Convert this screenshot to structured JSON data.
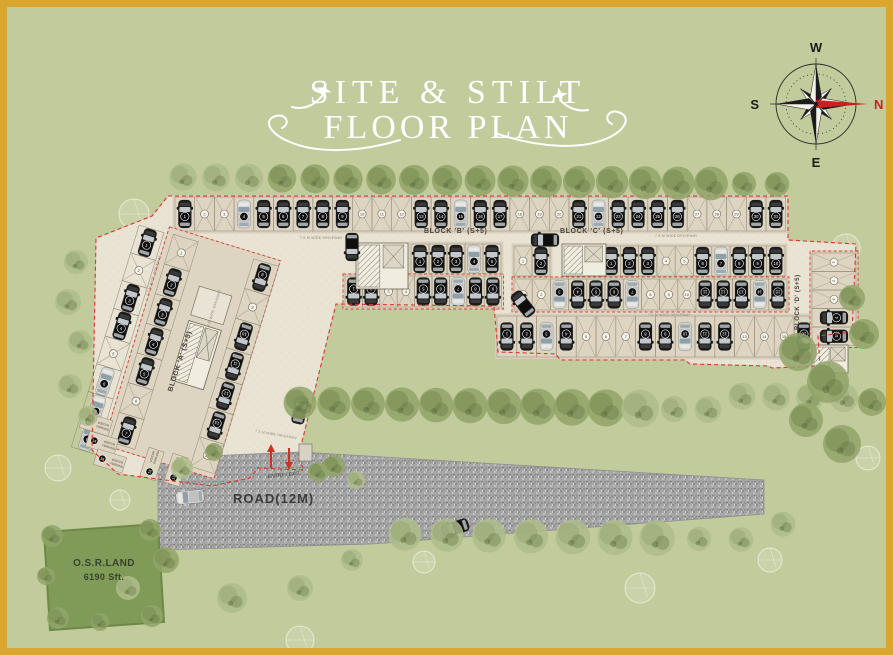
{
  "title": {
    "line1": "SITE & STILT",
    "line2": "FLOOR PLAN"
  },
  "compass": {
    "top": "W",
    "left": "S",
    "right": "N",
    "bottom": "E"
  },
  "plan": {
    "block_a_label": "BLOCK 'A' (S+5)",
    "block_b_label": "BLOCK 'B' (S+5)",
    "block_c_label": "BLOCK 'C' (S+5)",
    "block_d_label": "BLOCK 'D' (S+5)",
    "road_label": "ROAD(12M)",
    "osr_line1": "O.S.R.LAND",
    "osr_line2": "6190 Sft.",
    "entry_label": "ENTRY / EXIT",
    "driveway_label": "7.5 M WIDE DRIVEWAY",
    "visitor_label_line1": "VISITOR",
    "visitor_label_line2": "PARKING"
  },
  "colors": {
    "background": "#c2cb9b",
    "frame_gold": "#d9a630",
    "pavement": "#e9e3d4",
    "stall_bed": "#ddd5c1",
    "road": "#a6a6a6",
    "boundary_red": "#e03428",
    "osr_green": "#7f9b57",
    "tree_dark": "#7e9257",
    "tree_light": "#aebd8b",
    "car_dark": "#1c1c1c",
    "car_silver": "#d6d6d4",
    "north_red": "#cc1f1f"
  }
}
